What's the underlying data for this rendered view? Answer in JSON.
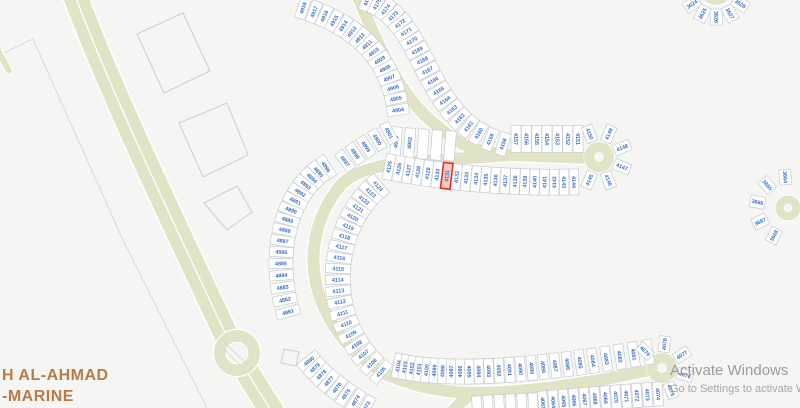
{
  "map": {
    "selected_parcel": "4131",
    "road_label_line1": "H AL-AHMAD",
    "road_label_line2": "-MARINE",
    "colors": {
      "background": "#f5f5f4",
      "road_fill": "#e0e3c6",
      "road_casing": "#ffffff",
      "parcel_fill": "#ffffff",
      "parcel_stroke": "#c6c9d0",
      "parcel_number_text": "#3a6dc0",
      "selected_parcel_fill": "#f5c9c4",
      "selected_parcel_stroke": "#dd3427",
      "road_label_text": "#b87b47",
      "watermark_text": "#9b9b9b"
    },
    "parcel_groups": [
      {
        "id": "col-4918-4904",
        "nums": [
          "4918",
          "4917",
          "4916",
          "4915",
          "4914",
          "4913",
          "4912",
          "4911",
          "4910",
          "4909",
          "4908",
          "4907",
          "4906",
          "4905",
          "4904"
        ],
        "pts": [
          [
            303,
            8
          ],
          [
            355,
            25
          ],
          [
            390,
            55
          ],
          [
            398,
            110
          ]
        ],
        "w": 10.5,
        "d": 22
      },
      {
        "id": "row-4903-4902",
        "nums": [
          "4903",
          "4902",
          "",
          "",
          ""
        ],
        "pts": [
          [
            396,
            142
          ],
          [
            423,
            144
          ],
          [
            450,
            146
          ]
        ],
        "w": 10.5,
        "d": 30
      },
      {
        "id": "arc-4901-4897",
        "nums": [
          "4901",
          "4900",
          "4899",
          "4898",
          "4897"
        ],
        "pts": [
          [
            389,
            133
          ],
          [
            365,
            146
          ],
          [
            345,
            161
          ]
        ],
        "w": 10,
        "d": 22
      },
      {
        "id": "col-4176-4158",
        "nums": [
          "4176",
          "4175",
          "4174",
          "4173",
          "4172",
          "4171",
          "4170",
          "4169",
          "4168",
          "4167",
          "4166",
          "4165",
          "4164",
          "4163",
          "4162",
          "4161",
          "4160",
          "4159",
          "4158"
        ],
        "pts": [
          [
            367,
            0
          ],
          [
            430,
            20
          ],
          [
            420,
            120
          ],
          [
            503,
            144
          ]
        ],
        "w": 10.5,
        "d": 23
      },
      {
        "id": "row-4157-4151",
        "nums": [
          "4157",
          "4156",
          "4155",
          "4154",
          "4153",
          "4152",
          "4151"
        ],
        "pts": [
          [
            516,
            139
          ],
          [
            547,
            139
          ],
          [
            578,
            139
          ]
        ],
        "w": 10,
        "d": 27
      },
      {
        "id": "fan-4150-4145",
        "type": "arc",
        "nums": [
          "4150",
          "4149",
          "4148",
          "4147",
          "4146",
          "4145"
        ],
        "cx": 599,
        "cy": 157,
        "r": 25,
        "a0": -112,
        "a1": 113,
        "w": 11,
        "d": 17
      },
      {
        "id": "row-4144-4125",
        "sel": "4131",
        "nums": [
          "4144",
          "4143",
          "4142",
          "4141",
          "4140",
          "4139",
          "4138",
          "4137",
          "4136",
          "4135",
          "4134",
          "4133",
          "4132",
          "4131",
          "4130",
          "4129",
          "4128",
          "4127",
          "4126",
          "4125"
        ],
        "pts": [
          [
            574,
            182
          ],
          [
            480,
            184
          ],
          [
            389,
            167
          ]
        ],
        "w": 9.5,
        "d": 26
      },
      {
        "id": "col-4124-4105",
        "nums": [
          "4124",
          "4123",
          "4122",
          "4121",
          "4120",
          "4119",
          "4118",
          "4117",
          "4116",
          "4115",
          "4114",
          "4113",
          "4112",
          "4111",
          "4110",
          "4109",
          "4108",
          "4107",
          "4106",
          "4105"
        ],
        "pts": [
          [
            378,
            186
          ],
          [
            330,
            225
          ],
          [
            318,
            320
          ],
          [
            381,
            372
          ]
        ],
        "w": 9.5,
        "d": 25
      },
      {
        "id": "col-4896-4881",
        "nums": [
          "4896",
          "4895",
          "4894",
          "4893",
          "4892",
          "4891",
          "4890",
          "4889",
          "4888",
          "4887",
          "4886",
          "4885",
          "4884",
          "4883",
          "4882",
          "4881"
        ],
        "pts": [
          [
            326,
            167
          ],
          [
            288,
            190
          ],
          [
            270,
            250
          ],
          [
            288,
            312
          ]
        ],
        "w": 10,
        "d": 24
      },
      {
        "id": "arc-4880-4873",
        "nums": [
          "4880",
          "4879",
          "4878",
          "4877",
          "4876",
          "4875",
          "4874",
          "4873"
        ],
        "pts": [
          [
            309,
            361
          ],
          [
            328,
            385
          ],
          [
            366,
            407
          ]
        ],
        "w": 10,
        "d": 24
      },
      {
        "id": "row-4104-4080",
        "nums": [
          "4104",
          "4103",
          "4102",
          "4101",
          "4100",
          "4099",
          "4098",
          "4097",
          "4096",
          "4095",
          "4094",
          "4093",
          "4092",
          "4091",
          "4090",
          "4089",
          "4088",
          "4087",
          "4086",
          "4085",
          "4084",
          "4083",
          "4082",
          "4081",
          "4080"
        ],
        "pts": [
          [
            398,
            366
          ],
          [
            475,
            382
          ],
          [
            648,
            352
          ]
        ],
        "w": 9.5,
        "d": 25
      },
      {
        "id": "fan-4079-4075",
        "type": "arc",
        "nums": [
          "4079",
          "4078",
          "4077",
          "4076",
          "4075"
        ],
        "cx": 662,
        "cy": 368,
        "r": 24,
        "a0": -135,
        "a1": 68,
        "w": 11,
        "d": 16
      },
      {
        "id": "row-4074-4063",
        "nums": [
          "4074",
          "4073",
          "4072",
          "4071",
          "4070",
          "4069",
          "4068",
          "4067",
          "4066",
          "4065",
          "4064",
          "4063"
        ],
        "pts": [
          [
            658,
            394
          ],
          [
            600,
            398
          ],
          [
            543,
            403
          ]
        ],
        "w": 9.5,
        "d": 24
      },
      {
        "id": "row-blank-bottom",
        "nums": [
          "",
          "",
          "",
          "",
          "",
          ""
        ],
        "pts": [
          [
            533,
            404
          ],
          [
            505,
            405
          ],
          [
            477,
            407
          ]
        ],
        "w": 9.5,
        "d": 22
      },
      {
        "id": "fan-3624-3628",
        "type": "arc",
        "nums": [
          "3624",
          "3625",
          "3626",
          "3627",
          "3628"
        ],
        "cx": 716,
        "cy": -12,
        "r": 29,
        "a0": 146,
        "a1": 33,
        "w": 12,
        "d": 16
      },
      {
        "id": "fan-3664-3668",
        "type": "arc",
        "nums": [
          "3664",
          "3665",
          "3666",
          "3667",
          "3668"
        ],
        "cx": 788,
        "cy": 208,
        "r": 31,
        "a0": -95,
        "a1": -243,
        "w": 12,
        "d": 15
      }
    ]
  },
  "watermark": {
    "line1": "Activate Windows",
    "line2": "Go to Settings to activate W"
  }
}
